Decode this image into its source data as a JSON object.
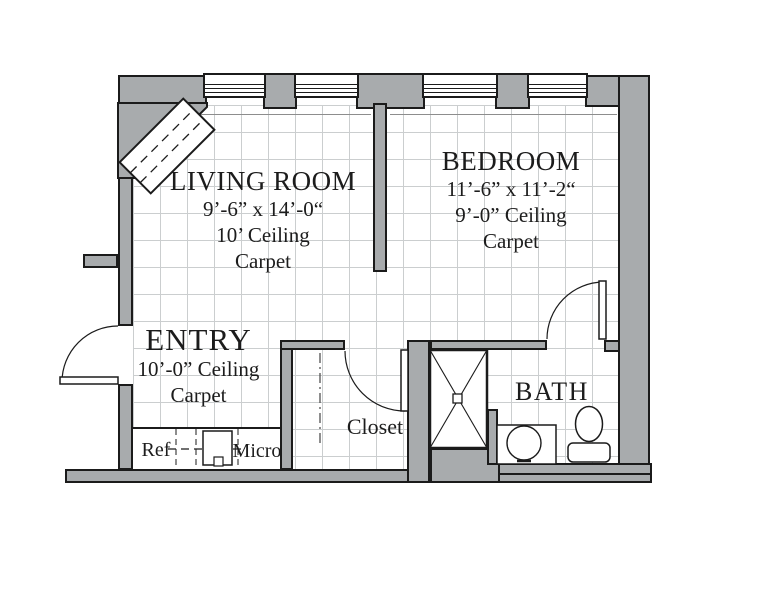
{
  "title": "Apartment floor plan",
  "colors": {
    "wall_fill": "#a8abad",
    "outline": "#1b1b1b",
    "grid_line": "#cbcecf",
    "text": "#1c1c1c",
    "floor": "#ffffff"
  },
  "rooms": {
    "living_room": {
      "name": "LIVING ROOM",
      "dimensions": "9’-6” x 14’-0“",
      "ceiling": "10’ Ceiling",
      "floor": "Carpet"
    },
    "bedroom": {
      "name": "BEDROOM",
      "dimensions": "11’-6” x 11’-2“",
      "ceiling": "9’-0” Ceiling",
      "floor": "Carpet"
    },
    "entry": {
      "name": "ENTRY",
      "ceiling": "10’-0” Ceiling",
      "floor": "Carpet"
    },
    "closet": {
      "name": "Closet"
    },
    "bath": {
      "name": "BATH"
    }
  },
  "fixtures": {
    "refrigerator_label": "Ref",
    "microwave_label": "Micro"
  }
}
